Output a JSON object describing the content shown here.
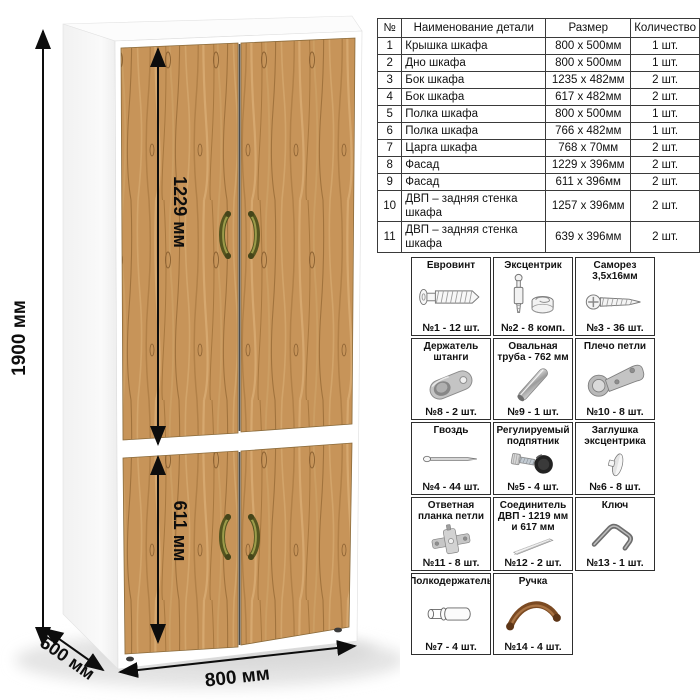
{
  "colors": {
    "wood": "#c79459",
    "handle_bronze": "#6f6f2e",
    "cabinet_white": "#ffffff",
    "dimension_line": "#111111",
    "table_border": "#3a3a3a"
  },
  "dimensions": {
    "height": "1900 мм",
    "upper_facade_height": "1229 мм",
    "lower_facade_height": "611 мм",
    "width": "800 мм",
    "depth": "500 мм"
  },
  "parts_table": {
    "headers": [
      "№",
      "Наименование детали",
      "Размер",
      "Количество"
    ],
    "rows": [
      [
        "1",
        "Крышка шкафа",
        "800 x 500мм",
        "1 шт."
      ],
      [
        "2",
        "Дно шкафа",
        "800 x 500мм",
        "1 шт."
      ],
      [
        "3",
        "Бок шкафа",
        "1235 x 482мм",
        "2 шт."
      ],
      [
        "4",
        "Бок шкафа",
        "617 x 482мм",
        "2 шт."
      ],
      [
        "5",
        "Полка шкафа",
        "800 x 500мм",
        "1 шт."
      ],
      [
        "6",
        "Полка шкафа",
        "766 x 482мм",
        "1 шт."
      ],
      [
        "7",
        "Царга шкафа",
        "768 x 70мм",
        "2 шт."
      ],
      [
        "8",
        "Фасад",
        "1229 x 396мм",
        "2 шт."
      ],
      [
        "9",
        "Фасад",
        "611 x 396мм",
        "2 шт."
      ],
      [
        "10",
        "ДВП – задняя стенка шкафа",
        "1257 x 396мм",
        "2 шт."
      ],
      [
        "11",
        "ДВП – задняя стенка шкафа",
        "639 x 396мм",
        "2 шт."
      ]
    ]
  },
  "hardware": {
    "items": [
      {
        "name": "Евровинт",
        "count": "№1 - 12 шт.",
        "icon": "euro-screw-icon"
      },
      {
        "name": "Эксцентрик",
        "count": "№2 - 8 комп.",
        "icon": "cam-lock-icon"
      },
      {
        "name": "Саморез 3,5х16мм",
        "count": "№3 - 36 шт.",
        "icon": "self-tapping-screw-icon"
      },
      {
        "name": "Держатель штанги",
        "count": "№8 - 2 шт.",
        "icon": "rod-holder-icon"
      },
      {
        "name": "Овальная труба - 762 мм",
        "count": "№9 - 1 шт.",
        "icon": "oval-tube-icon"
      },
      {
        "name": "Плечо петли",
        "count": "№10 - 8 шт.",
        "icon": "hinge-arm-icon"
      },
      {
        "name": "Гвоздь",
        "count": "№4 - 44 шт.",
        "icon": "nail-icon"
      },
      {
        "name": "Регулируемый подпятник",
        "count": "№5 - 4 шт.",
        "icon": "adjustable-foot-icon"
      },
      {
        "name": "Заглушка эксцентрика",
        "count": "№6 - 8 шт.",
        "icon": "cam-cover-icon"
      },
      {
        "name": "Ответная планка петли",
        "count": "№11 - 8 шт.",
        "icon": "hinge-plate-icon"
      },
      {
        "name": "Соединитель ДВП - 1219 мм и 617 мм",
        "count": "№12 - 2 шт.",
        "icon": "hdf-connector-icon"
      },
      {
        "name": "Ключ",
        "count": "№13 - 1 шт.",
        "icon": "hex-key-icon"
      },
      {
        "name": "Полкодержатель",
        "count": "№7 - 4 шт.",
        "icon": "shelf-pin-icon"
      },
      {
        "name": "Ручка",
        "count": "№14 - 4 шт.",
        "icon": "handle-icon"
      }
    ]
  }
}
